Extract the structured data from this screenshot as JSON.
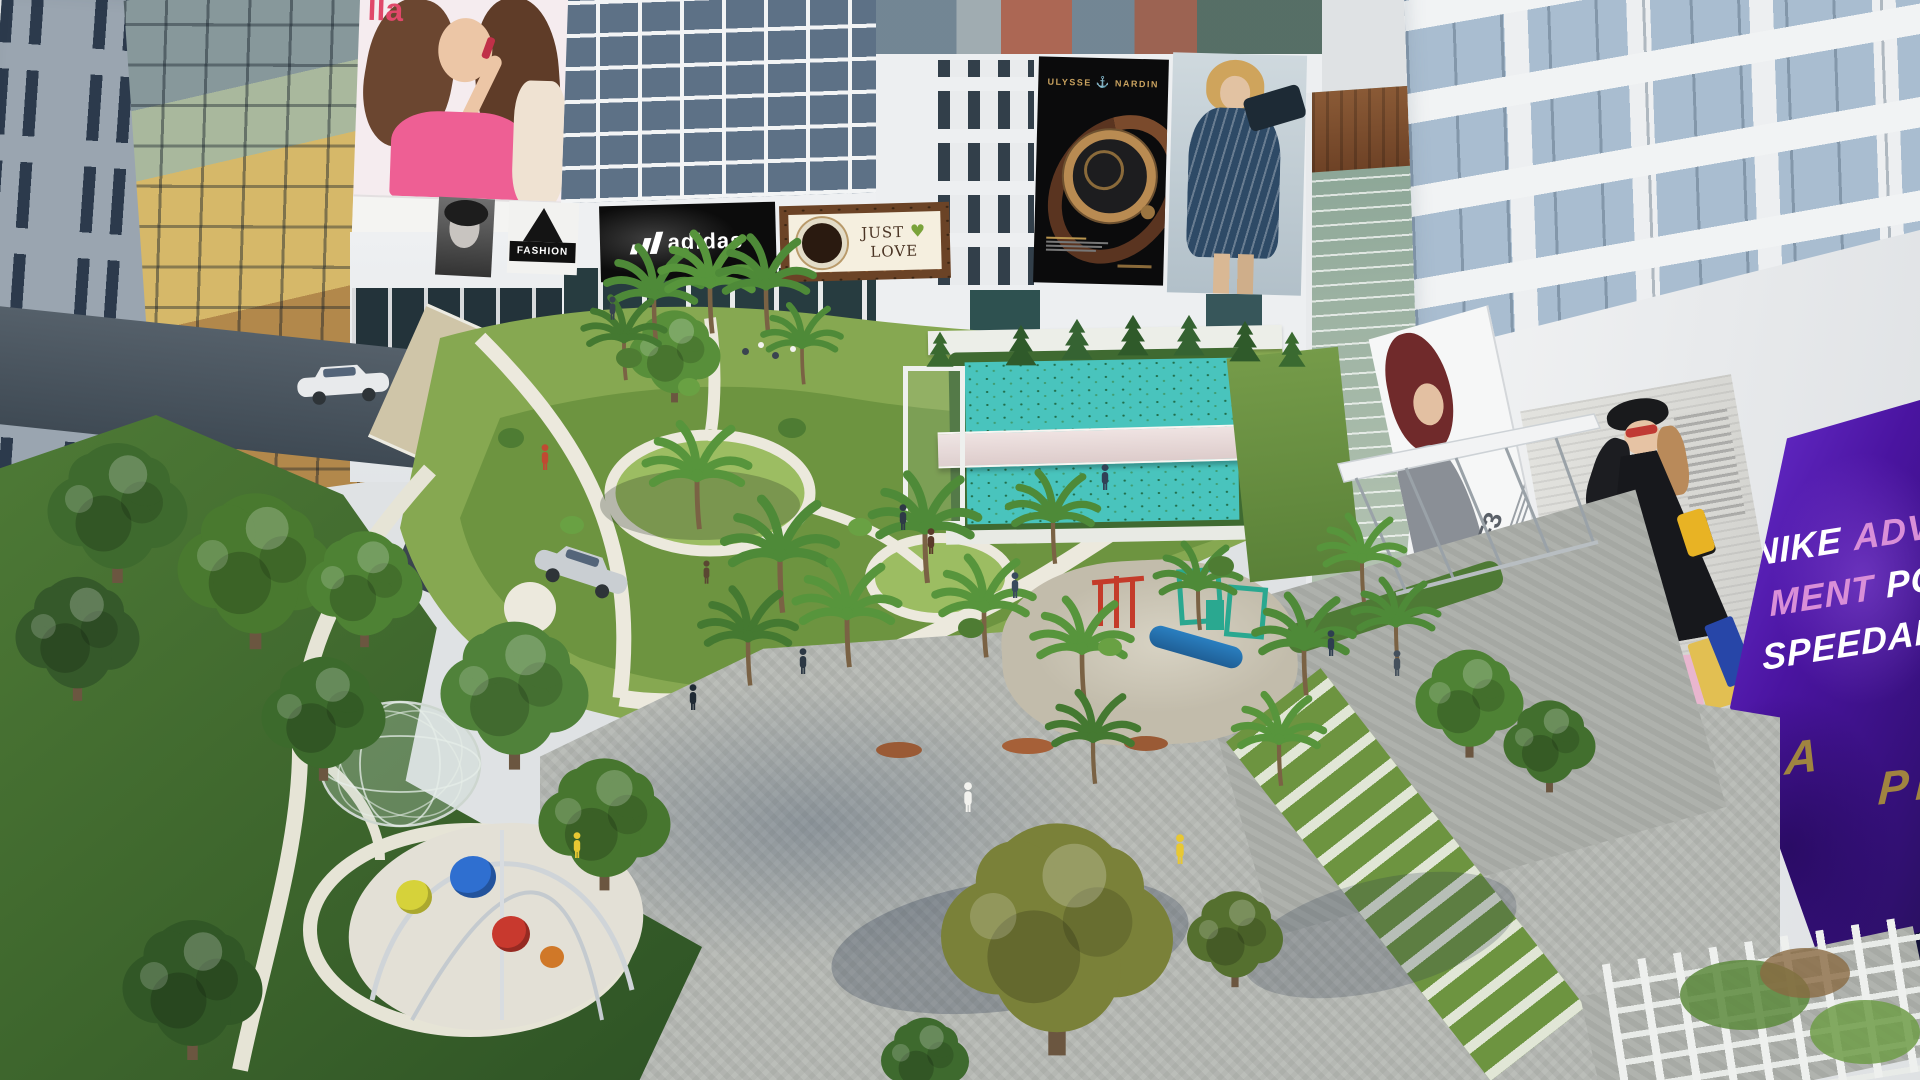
{
  "scene": {
    "title": "Aerial architectural rendering of a mixed-use apartment complex with landscaped courtyard, pools, playgrounds and facade billboards"
  },
  "billboards": {
    "lipstick": {
      "partial_text": "lla"
    },
    "fashion": {
      "title": "FASHION"
    },
    "adidas": {
      "brand": "adidas"
    },
    "just_love": {
      "word1": "JUST",
      "heart": "♥",
      "word2": "LOVE"
    },
    "ulysse_nardin": {
      "brand1": "ULYSSE",
      "anchor": "⚓",
      "brand2": "NARDIN"
    },
    "f3": {
      "label": "F3"
    },
    "nike": {
      "line1_white": "NIKE",
      "line1_pink": "ADVE",
      "line2_pink": "MENT",
      "line2_white": "POST",
      "line3": "SPEEDART"
    }
  },
  "signs": {
    "lotteria": "LOTTERIA",
    "partial_right": "PI"
  },
  "palette": {
    "pool": "#49c4bd",
    "lawn": "#86a851",
    "dark_lawn": "#3c642c",
    "plaza": "#b5b8b3",
    "nike_purple": "#451a8e",
    "gold_text": "#a08440",
    "glass_green": "#9fb4a4",
    "glass_blue": "#a9bdd0"
  }
}
